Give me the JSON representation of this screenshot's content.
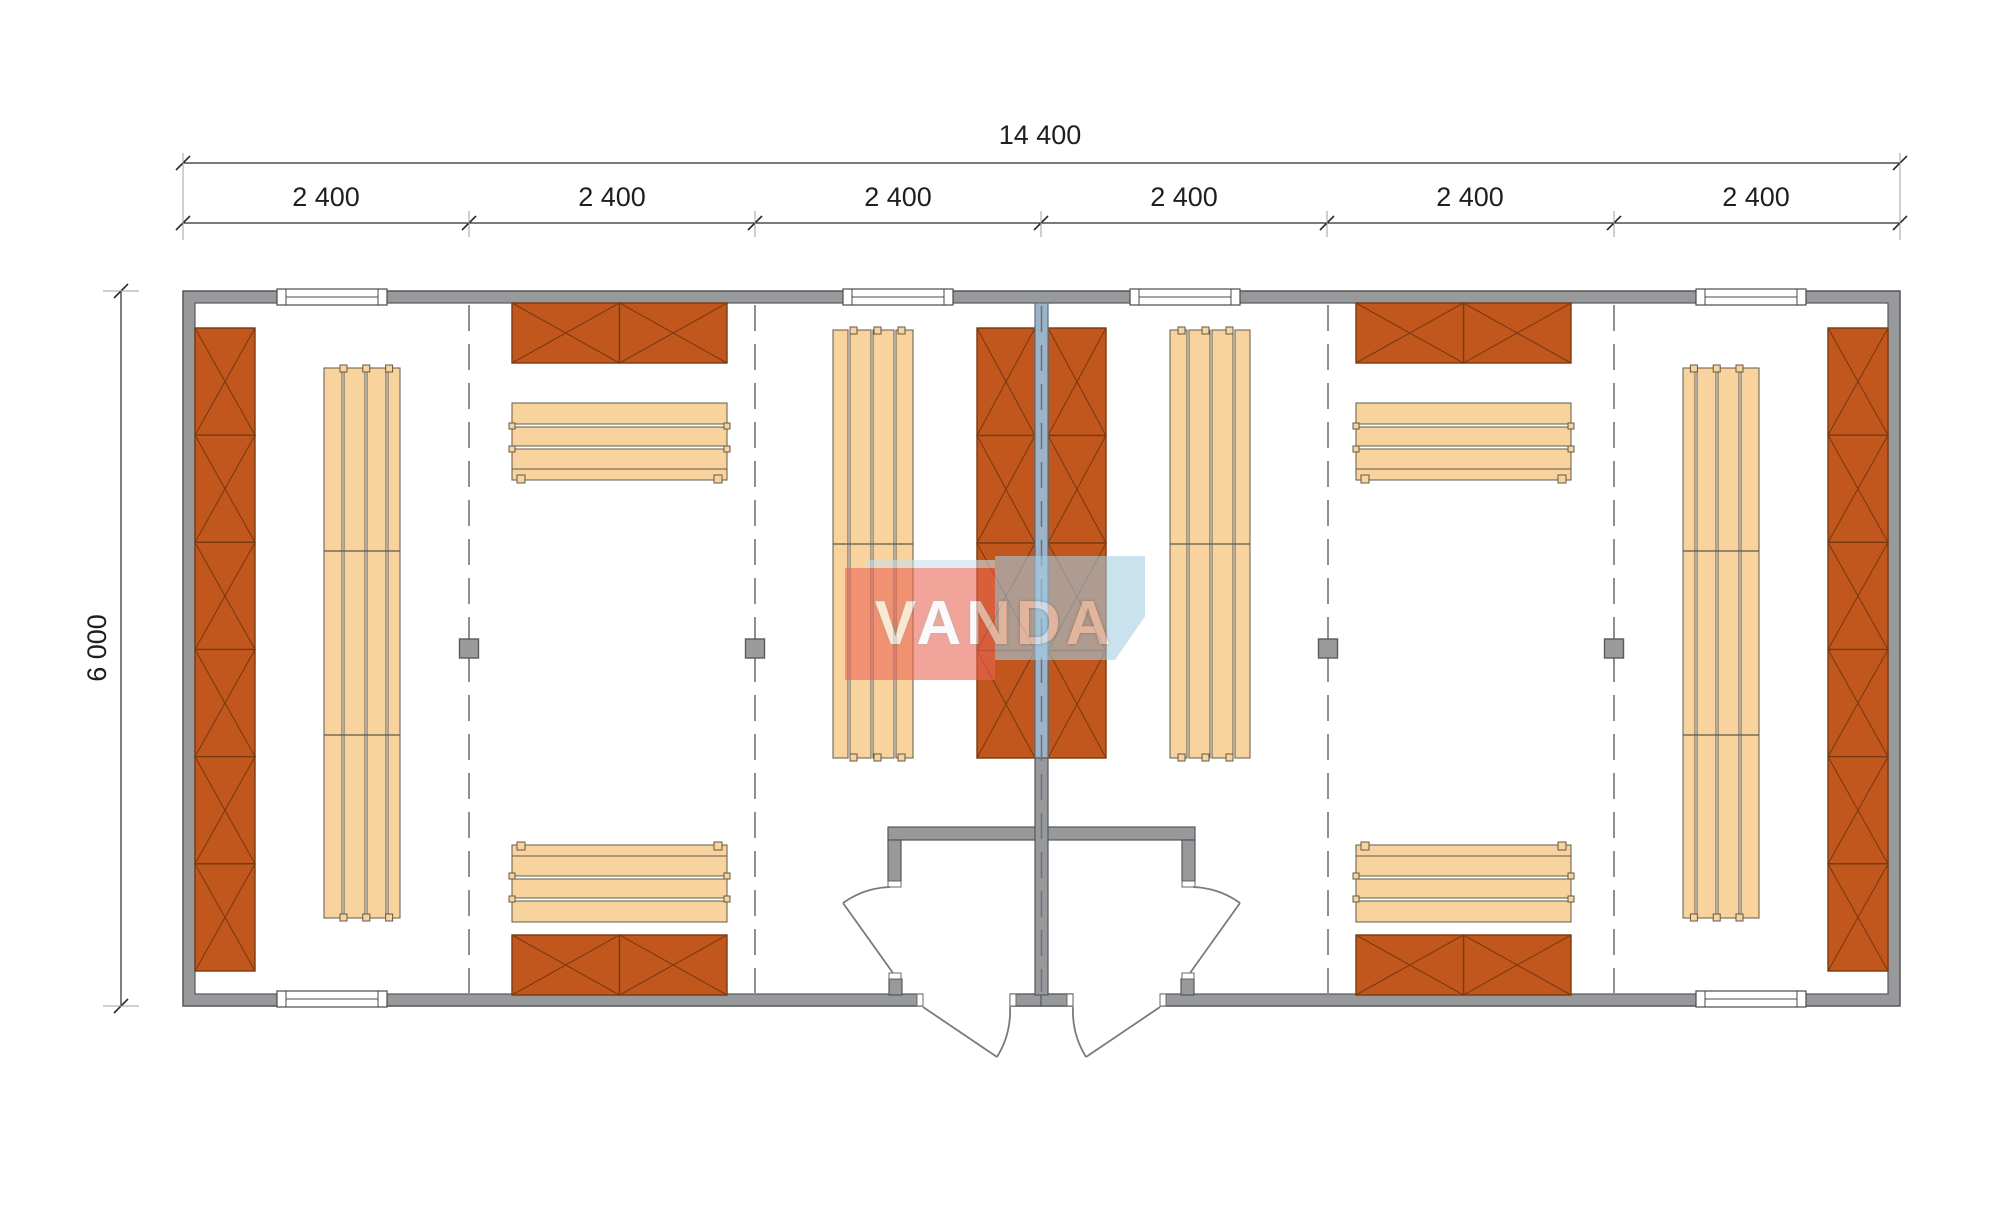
{
  "dimensions": {
    "overall_width": "14 400",
    "module_widths": [
      "2 400",
      "2 400",
      "2 400",
      "2 400",
      "2 400",
      "2 400"
    ],
    "overall_height": "6 000"
  },
  "watermark": {
    "text": "VANDA"
  },
  "colors": {
    "wall": "#98999b",
    "wall_stroke": "#55575a",
    "partition": "#9db3c7",
    "partition_stroke": "#5d6e7e",
    "locker": "#c2571d",
    "locker_stroke": "#7a3a12",
    "bench": "#f9d39e",
    "bench_stroke": "#5f584a",
    "door_stroke": "#7a7a7a",
    "axis": "#8f8f8f",
    "dim": "#2b2b2b",
    "watermark_red": "#eb6452",
    "watermark_blue": "#a4cde3"
  }
}
